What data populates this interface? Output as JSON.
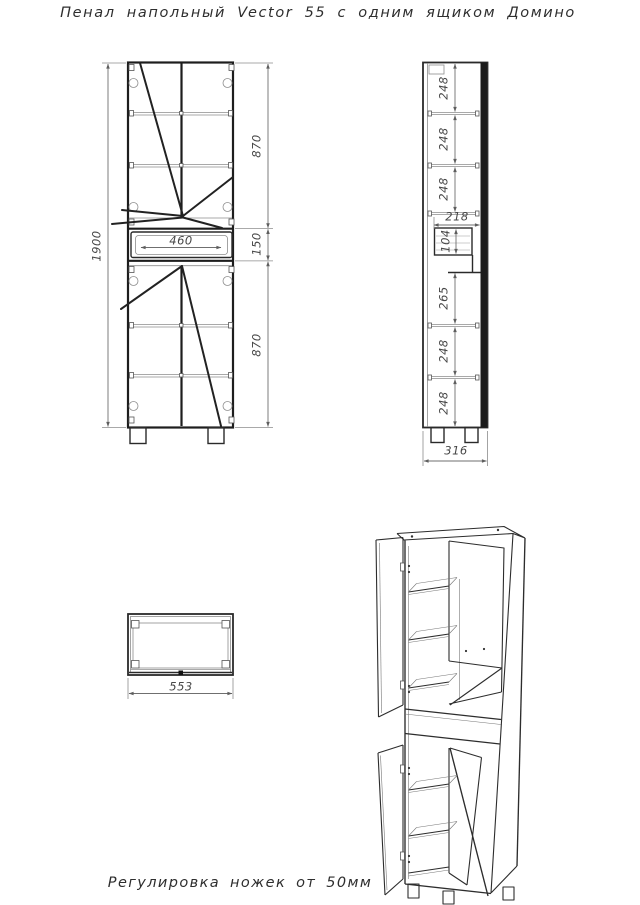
{
  "title": "Пенал напольный Vector 55 с одним ящиком Домино",
  "caption": "Регулировка ножек от 50мм",
  "front_view": {
    "total_height": "1900",
    "upper_door_height": "870",
    "drawer_inner_width": "460",
    "drawer_front_height": "150",
    "lower_door_height": "870"
  },
  "side_view": {
    "top_shelf_gaps": [
      "248",
      "248",
      "248"
    ],
    "drawer_depth": "218",
    "drawer_box_height": "104",
    "below_drawer_gap": "265",
    "bottom_shelf_gaps": [
      "248",
      "248"
    ],
    "overall_depth": "316"
  },
  "top_view": {
    "overall_width": "553"
  }
}
